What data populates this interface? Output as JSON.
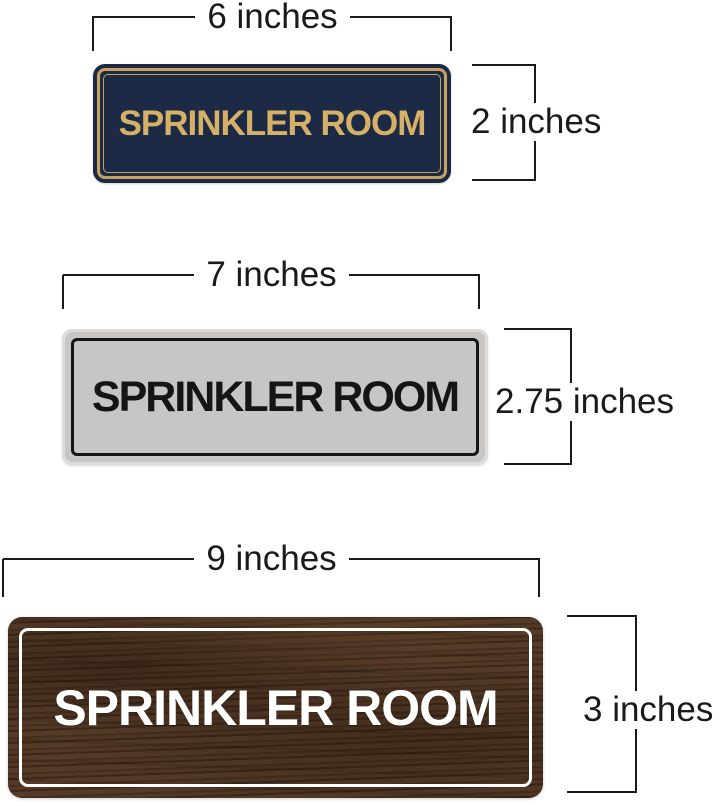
{
  "page": {
    "background": "#ffffff"
  },
  "annotation": {
    "line_color": "#1a1a1a",
    "text_color": "#1a1a1a"
  },
  "signs": [
    {
      "name": "navy-gold-sign",
      "text": "SPRINKLER ROOM",
      "width_label": "6 inches",
      "height_label": "2 inches",
      "colors": {
        "background": "#1c2a45",
        "text": "#d7b068",
        "border": "#c8a260"
      }
    },
    {
      "name": "silver-sign",
      "text": "SPRINKLER ROOM",
      "width_label": "7 inches",
      "height_label": "2.75 inches",
      "colors": {
        "background": "#c7c6c4",
        "rim": "#dddcda",
        "text": "#151515",
        "border": "#151515"
      }
    },
    {
      "name": "walnut-wood-sign",
      "text": "SPRINKLER ROOM",
      "width_label": "9 inches",
      "height_label": "3 inches",
      "colors": {
        "background": "#4c3423",
        "text": "#ffffff",
        "border": "#ffffff"
      }
    }
  ]
}
